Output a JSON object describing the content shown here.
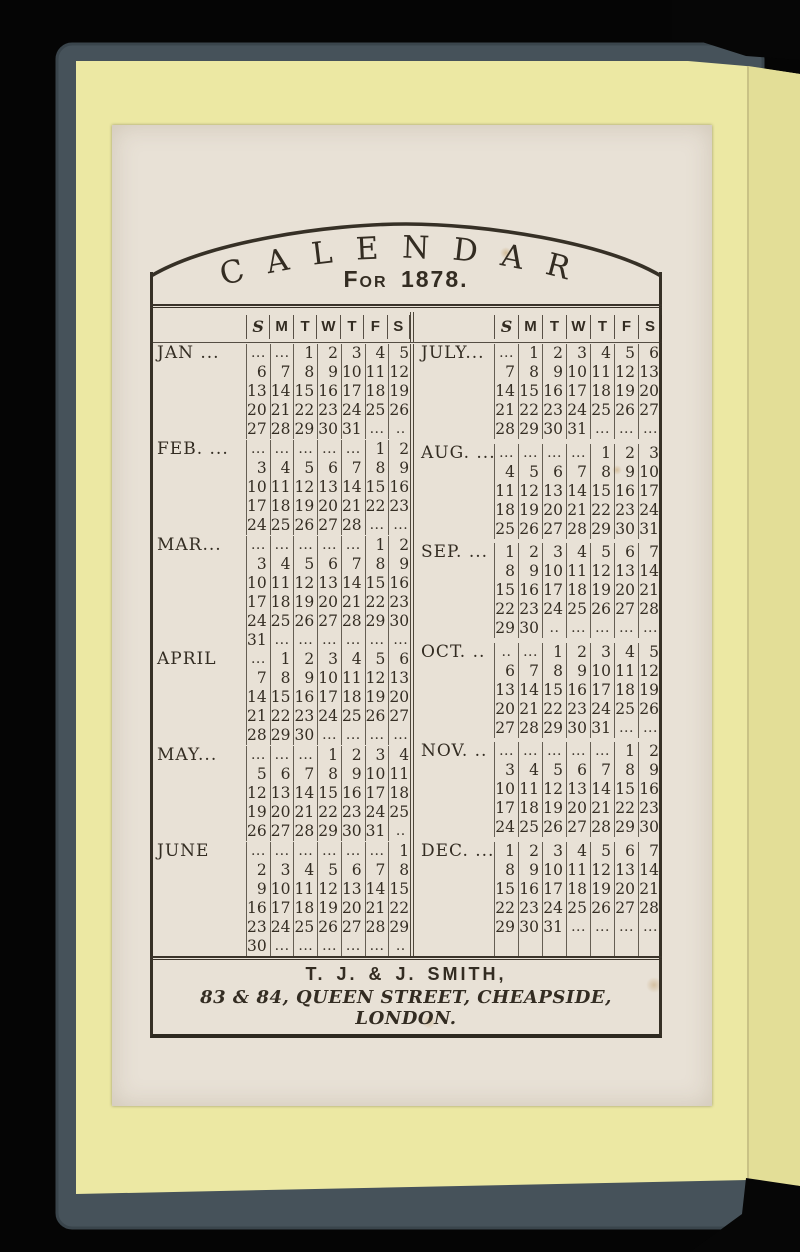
{
  "book": {
    "background_color": "#050505",
    "cover_color": "#46525a",
    "endpaper_color": "#ece8a3",
    "endpaper_fold_color": "#e3de97",
    "page_color": "#e8e1d6",
    "ink_color": "#332c22"
  },
  "calendar": {
    "title": "CALENDAR",
    "subtitle": "For 1878.",
    "day_headers": [
      "S",
      "M",
      "T",
      "W",
      "T",
      "F",
      "S"
    ],
    "footer_line1": "T. J. & J. SMITH,",
    "footer_line2": "83 & 84, QUEEN STREET, CHEAPSIDE, LONDON.",
    "left_months": [
      {
        "label": "JAN ...",
        "rows": [
          [
            "...",
            "...",
            "1",
            "2",
            "3",
            "4",
            "5"
          ],
          [
            "6",
            "7",
            "8",
            "9",
            "10",
            "11",
            "12"
          ],
          [
            "13",
            "14",
            "15",
            "16",
            "17",
            "18",
            "19"
          ],
          [
            "20",
            "21",
            "22",
            "23",
            "24",
            "25",
            "26"
          ],
          [
            "27",
            "28",
            "29",
            "30",
            "31",
            "...",
            ".."
          ]
        ]
      },
      {
        "label": "FEB. ...",
        "rows": [
          [
            "...",
            "...",
            "...",
            "...",
            "...",
            "1",
            "2"
          ],
          [
            "3",
            "4",
            "5",
            "6",
            "7",
            "8",
            "9"
          ],
          [
            "10",
            "11",
            "12",
            "13",
            "14",
            "15",
            "16"
          ],
          [
            "17",
            "18",
            "19",
            "20",
            "21",
            "22",
            "23"
          ],
          [
            "24",
            "25",
            "26",
            "27",
            "28",
            "...",
            "..."
          ]
        ]
      },
      {
        "label": "MAR...",
        "rows": [
          [
            "...",
            "...",
            "...",
            "...",
            "...",
            "1",
            "2"
          ],
          [
            "3",
            "4",
            "5",
            "6",
            "7",
            "8",
            "9"
          ],
          [
            "10",
            "11",
            "12",
            "13",
            "14",
            "15",
            "16"
          ],
          [
            "17",
            "18",
            "19",
            "20",
            "21",
            "22",
            "23"
          ],
          [
            "24",
            "25",
            "26",
            "27",
            "28",
            "29",
            "30"
          ],
          [
            "31",
            "...",
            "...",
            "...",
            "...",
            "...",
            "..."
          ]
        ]
      },
      {
        "label": "APRIL",
        "rows": [
          [
            "...",
            "1",
            "2",
            "3",
            "4",
            "5",
            "6"
          ],
          [
            "7",
            "8",
            "9",
            "10",
            "11",
            "12",
            "13"
          ],
          [
            "14",
            "15",
            "16",
            "17",
            "18",
            "19",
            "20"
          ],
          [
            "21",
            "22",
            "23",
            "24",
            "25",
            "26",
            "27"
          ],
          [
            "28",
            "29",
            "30",
            "...",
            "...",
            "...",
            "..."
          ]
        ]
      },
      {
        "label": "MAY...",
        "rows": [
          [
            "...",
            "...",
            "...",
            "1",
            "2",
            "3",
            "4"
          ],
          [
            "5",
            "6",
            "7",
            "8",
            "9",
            "10",
            "11"
          ],
          [
            "12",
            "13",
            "14",
            "15",
            "16",
            "17",
            "18"
          ],
          [
            "19",
            "20",
            "21",
            "22",
            "23",
            "24",
            "25"
          ],
          [
            "26",
            "27",
            "28",
            "29",
            "30",
            "31",
            ".."
          ]
        ]
      },
      {
        "label": "JUNE",
        "rows": [
          [
            "...",
            "...",
            "...",
            "...",
            "...",
            "...",
            "1"
          ],
          [
            "2",
            "3",
            "4",
            "5",
            "6",
            "7",
            "8"
          ],
          [
            "9",
            "10",
            "11",
            "12",
            "13",
            "14",
            "15"
          ],
          [
            "16",
            "17",
            "18",
            "19",
            "20",
            "21",
            "22"
          ],
          [
            "23",
            "24",
            "25",
            "26",
            "27",
            "28",
            "29"
          ],
          [
            "30",
            "...",
            "...",
            "...",
            "...",
            "...",
            ".."
          ]
        ]
      }
    ],
    "right_months": [
      {
        "label": "JULY...",
        "rows": [
          [
            "...",
            "1",
            "2",
            "3",
            "4",
            "5",
            "6"
          ],
          [
            "7",
            "8",
            "9",
            "10",
            "11",
            "12",
            "13"
          ],
          [
            "14",
            "15",
            "16",
            "17",
            "18",
            "19",
            "20"
          ],
          [
            "21",
            "22",
            "23",
            "24",
            "25",
            "26",
            "27"
          ],
          [
            "28",
            "29",
            "30",
            "31",
            "...",
            "...",
            "..."
          ]
        ]
      },
      {
        "label": "AUG. ...",
        "rows": [
          [
            "...",
            "...",
            "...",
            "...",
            "1",
            "2",
            "3"
          ],
          [
            "4",
            "5",
            "6",
            "7",
            "8",
            "9",
            "10"
          ],
          [
            "11",
            "12",
            "13",
            "14",
            "15",
            "16",
            "17"
          ],
          [
            "18",
            "19",
            "20",
            "21",
            "22",
            "23",
            "24"
          ],
          [
            "25",
            "26",
            "27",
            "28",
            "29",
            "30",
            "31"
          ]
        ]
      },
      {
        "label": "SEP. ...",
        "rows": [
          [
            "1",
            "2",
            "3",
            "4",
            "5",
            "6",
            "7"
          ],
          [
            "8",
            "9",
            "10",
            "11",
            "12",
            "13",
            "14"
          ],
          [
            "15",
            "16",
            "17",
            "18",
            "19",
            "20",
            "21"
          ],
          [
            "22",
            "23",
            "24",
            "25",
            "26",
            "27",
            "28"
          ],
          [
            "29",
            "30",
            "..",
            "...",
            "...",
            "...",
            "..."
          ]
        ]
      },
      {
        "label": "OCT. ..",
        "rows": [
          [
            "..",
            "...",
            "1",
            "2",
            "3",
            "4",
            "5"
          ],
          [
            "6",
            "7",
            "8",
            "9",
            "10",
            "11",
            "12"
          ],
          [
            "13",
            "14",
            "15",
            "16",
            "17",
            "18",
            "19"
          ],
          [
            "20",
            "21",
            "22",
            "23",
            "24",
            "25",
            "26"
          ],
          [
            "27",
            "28",
            "29",
            "30",
            "31",
            "...",
            "..."
          ]
        ]
      },
      {
        "label": "NOV. ..",
        "rows": [
          [
            "...",
            "...",
            "...",
            "...",
            "...",
            "1",
            "2"
          ],
          [
            "3",
            "4",
            "5",
            "6",
            "7",
            "8",
            "9"
          ],
          [
            "10",
            "11",
            "12",
            "13",
            "14",
            "15",
            "16"
          ],
          [
            "17",
            "18",
            "19",
            "20",
            "21",
            "22",
            "23"
          ],
          [
            "24",
            "25",
            "26",
            "27",
            "28",
            "29",
            "30"
          ]
        ]
      },
      {
        "label": "DEC. ...",
        "rows": [
          [
            "1",
            "2",
            "3",
            "4",
            "5",
            "6",
            "7"
          ],
          [
            "8",
            "9",
            "10",
            "11",
            "12",
            "13",
            "14"
          ],
          [
            "15",
            "16",
            "17",
            "18",
            "19",
            "20",
            "21"
          ],
          [
            "22",
            "23",
            "24",
            "25",
            "26",
            "27",
            "28"
          ],
          [
            "29",
            "30",
            "31",
            "...",
            "...",
            "...",
            "..."
          ],
          [
            "",
            "",
            "",
            "",
            "",
            "",
            ""
          ]
        ]
      }
    ]
  }
}
